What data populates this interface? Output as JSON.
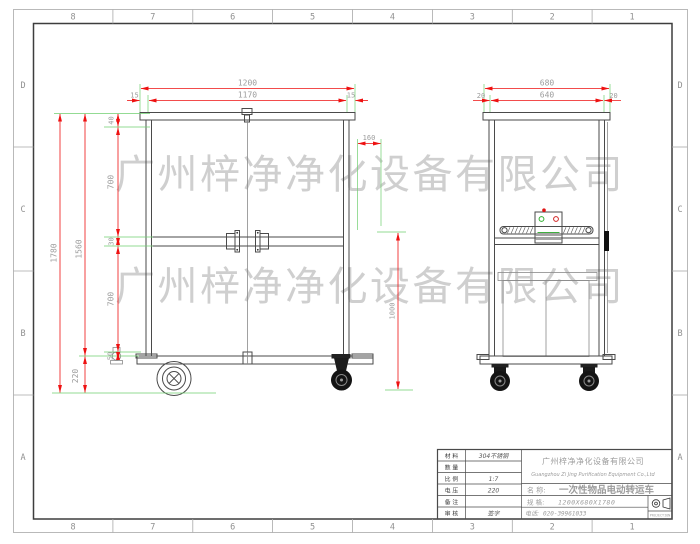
{
  "sheet": {
    "cols": [
      "8",
      "7",
      "6",
      "5",
      "4",
      "3",
      "2",
      "1"
    ],
    "rows": [
      "D",
      "C",
      "B",
      "A"
    ],
    "watermark": "广州梓净净化设备有限公司"
  },
  "dims": {
    "w_outer": "1200",
    "w_inner": "1170",
    "w_m_l": "15",
    "w_m_r": "15",
    "s_outer": "680",
    "s_inner": "640",
    "s_m_l": "20",
    "s_m_r": "20",
    "h_total": "1780",
    "h_body": "1560",
    "h_wheel": "220",
    "cap": "40",
    "p_up": "700",
    "rail": "30",
    "p_low": "700",
    "gap": "50",
    "handle_off": "160",
    "handle_h": "1000"
  },
  "tb": {
    "rows": [
      {
        "l": "材 料",
        "v": "304不锈钢"
      },
      {
        "l": "数 量",
        "v": ""
      },
      {
        "l": "比 例",
        "v": "1:7"
      },
      {
        "l": "电 压",
        "v": "220"
      },
      {
        "l": "备 注",
        "v": ""
      },
      {
        "l": "审 核",
        "v": "签字"
      }
    ],
    "cn": "广州梓净净化设备有限公司",
    "en": "Guangzhou Zi Jing Purification Equipment Co.,Ltd",
    "name_l": "名  称:",
    "name_v": "一次性物品电动转运车",
    "spec_l": "规  格:",
    "spec_v": "1200X680X1780",
    "tel_l": "电话:",
    "tel_v": "020-39961033",
    "proj": "PROJECTION"
  },
  "colors": {
    "dim_red": "#ee1111",
    "ext_green": "#6fcf6f",
    "watermark_gray": "#c4c4c4"
  }
}
